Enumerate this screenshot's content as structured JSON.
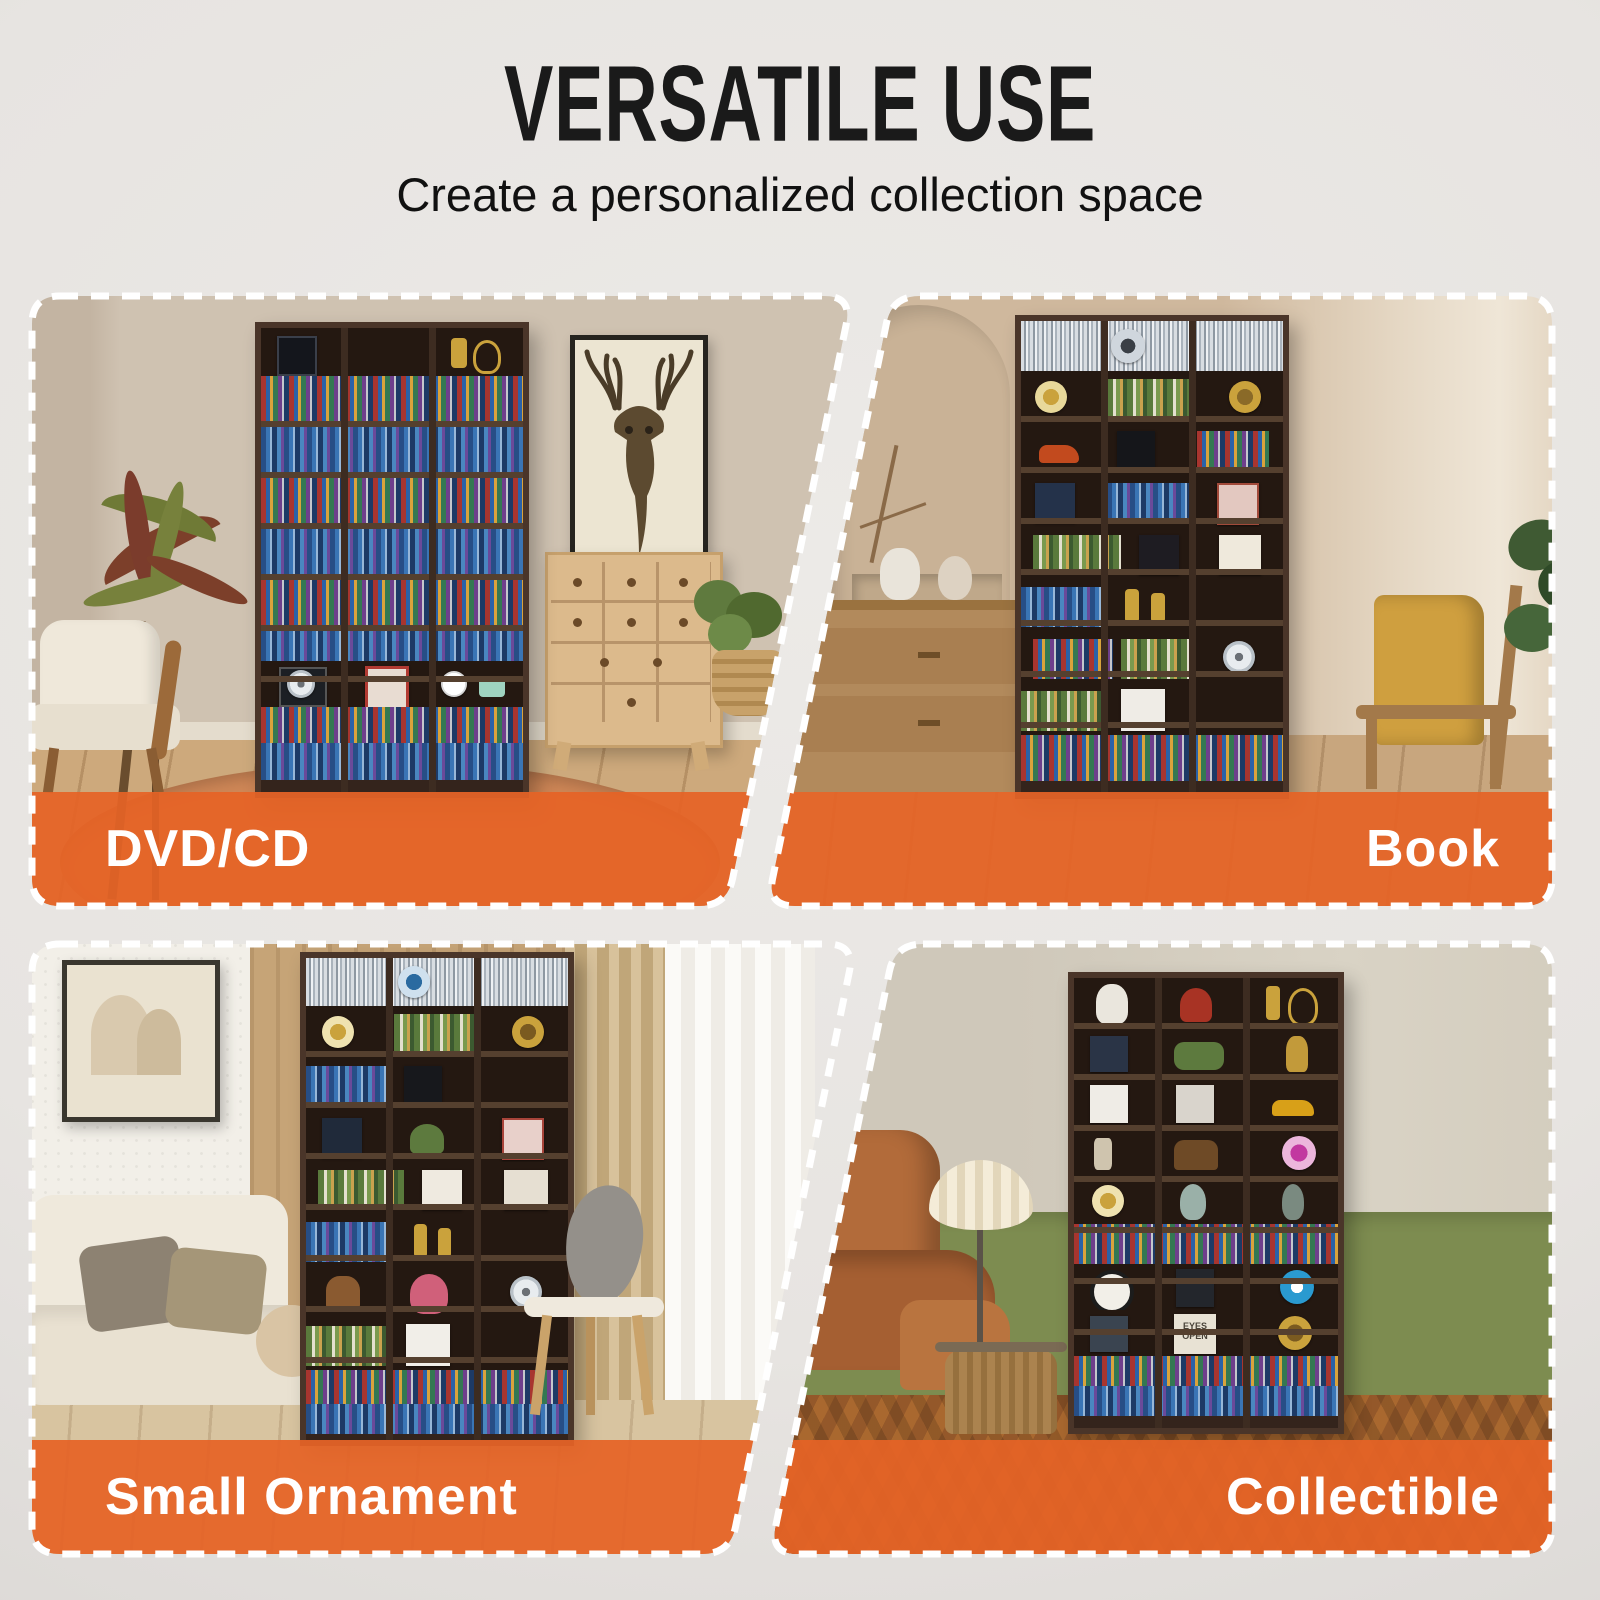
{
  "header": {
    "title": "VERSATILE USE",
    "subtitle": "Create a personalized collection space"
  },
  "theme": {
    "accent_orange": "#e56326",
    "page_background": "#e7e4e1",
    "title_color": "#1a1a1a",
    "banner_text_color": "#ffffff",
    "dash_border_color": "#ffffff"
  },
  "panels": [
    {
      "id": "dvd-cd",
      "label": "DVD/CD",
      "label_align": "left"
    },
    {
      "id": "book",
      "label": "Book",
      "label_align": "right"
    },
    {
      "id": "small-ornament",
      "label": "Small Ornament",
      "label_align": "left"
    },
    {
      "id": "collectible",
      "label": "Collectible",
      "label_align": "right"
    }
  ],
  "decor": {
    "album_text": "EYES OPEN"
  }
}
